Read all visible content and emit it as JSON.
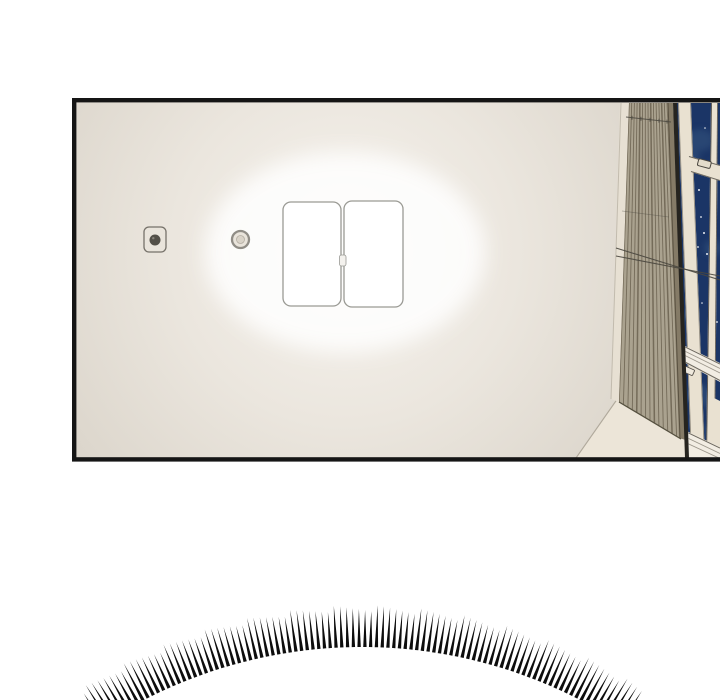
{
  "scene": {
    "kind": "comic-panel-illustration",
    "background_color": "#ffffff"
  },
  "palette": {
    "panel_border": "#151515",
    "ceiling_center": "#f6f3ee",
    "ceiling_mid": "#e7e2d9",
    "ceiling_edge": "#d3cdc2",
    "glow": "#ffffff",
    "light_fill": "#ffffff",
    "light_border": "#9a9a94",
    "detector_body": "#e9e4db",
    "detector_border": "#76726a",
    "detector_center": "#524f47",
    "sprinkler_ring": "#908d86",
    "sprinkler_fill": "#e9e4db",
    "blind_base": "#aaa28f",
    "blind_stripe": "#6b6250",
    "blind_rail": "#857b67",
    "edge_sliver": "#e7e0d3",
    "gap_dark": "#26241f",
    "frame_cream": "#e9e1d1",
    "frame_edge": "#8a8479",
    "sill_band": "#f2ede3",
    "sill_groove": "#9d978c",
    "wall_cream": "#ece5d8",
    "wall_edge": "#b0a99c",
    "sky": "#1b3566",
    "cloud": "#35547f",
    "star": "#ffffff",
    "cord": "#4a473f",
    "burst_color": "#0d0d0d"
  },
  "burst": {
    "cx": 362,
    "cy": 1122,
    "radius": 475,
    "spike_length": 39,
    "count": 96,
    "start_deg": -33,
    "end_deg": 33,
    "base_half_width": 1.7
  },
  "stars": [
    [
      699,
      190,
      1.0
    ],
    [
      711,
      194,
      0.9
    ],
    [
      713,
      204,
      1.0
    ],
    [
      701,
      217,
      0.9
    ],
    [
      716,
      216,
      0.8
    ],
    [
      704,
      233,
      1.0
    ],
    [
      698,
      247,
      0.9
    ],
    [
      707,
      254,
      1.0
    ],
    [
      710,
      292,
      0.9
    ],
    [
      702,
      303,
      0.8
    ],
    [
      717,
      322,
      0.9
    ],
    [
      705,
      128,
      0.8
    ],
    [
      714,
      120,
      0.7
    ],
    [
      697,
      378,
      0.9
    ],
    [
      708,
      410,
      0.8
    ]
  ],
  "clouds": [
    [
      700,
      140,
      14,
      11
    ],
    [
      690,
      156,
      10,
      7
    ],
    [
      713,
      248,
      9,
      8
    ],
    [
      686,
      318,
      7,
      6
    ],
    [
      699,
      396,
      14,
      12
    ],
    [
      712,
      430,
      10,
      8
    ]
  ],
  "blinds": {
    "stripes": 15
  },
  "cord_ticks": [
    632,
    641,
    650,
    659,
    667
  ]
}
